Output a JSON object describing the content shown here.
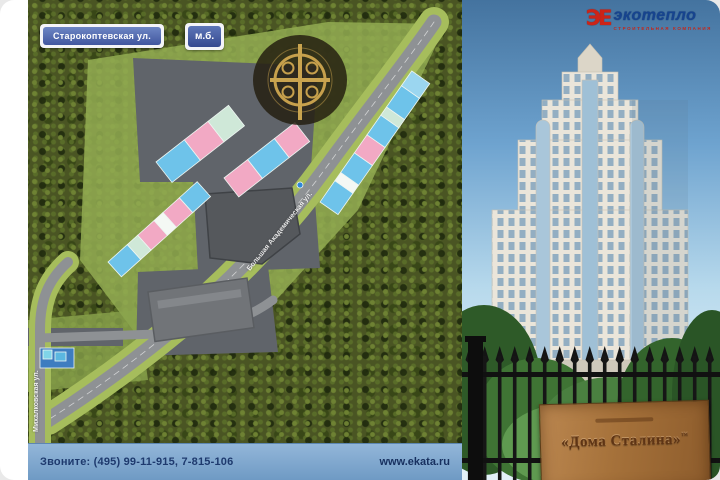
{
  "map": {
    "street_label": "Старокоптевская ул.",
    "corner_badge": "м.б.",
    "diagonal_road_label": "Большая Академическая ул.",
    "left_road_label": "Михалковская ул."
  },
  "contact_bar": {
    "phones": "Звоните: (495) 99-11-915, 7-815-106",
    "website": "www.ekata.ru"
  },
  "logo": {
    "mark": "ЭЕ",
    "name": "экотепло",
    "tagline": "СТРОИТЕЛЬНАЯ КОМПАНИЯ"
  },
  "sign": {
    "title": "«Дома Сталина»",
    "tm": "™"
  },
  "colors": {
    "contact_bar_blue": "#7fa8cd",
    "label_blue": "#41569f",
    "building_pink": "#f2a9c4",
    "building_blue": "#6ec3ea",
    "building_mint": "#cfe8d8",
    "logo_red": "#cc2418",
    "logo_blue": "#16448f",
    "sign_wood": "#a5713a",
    "foliage_green": "#4a5523",
    "road_gray": "#8e9194"
  }
}
